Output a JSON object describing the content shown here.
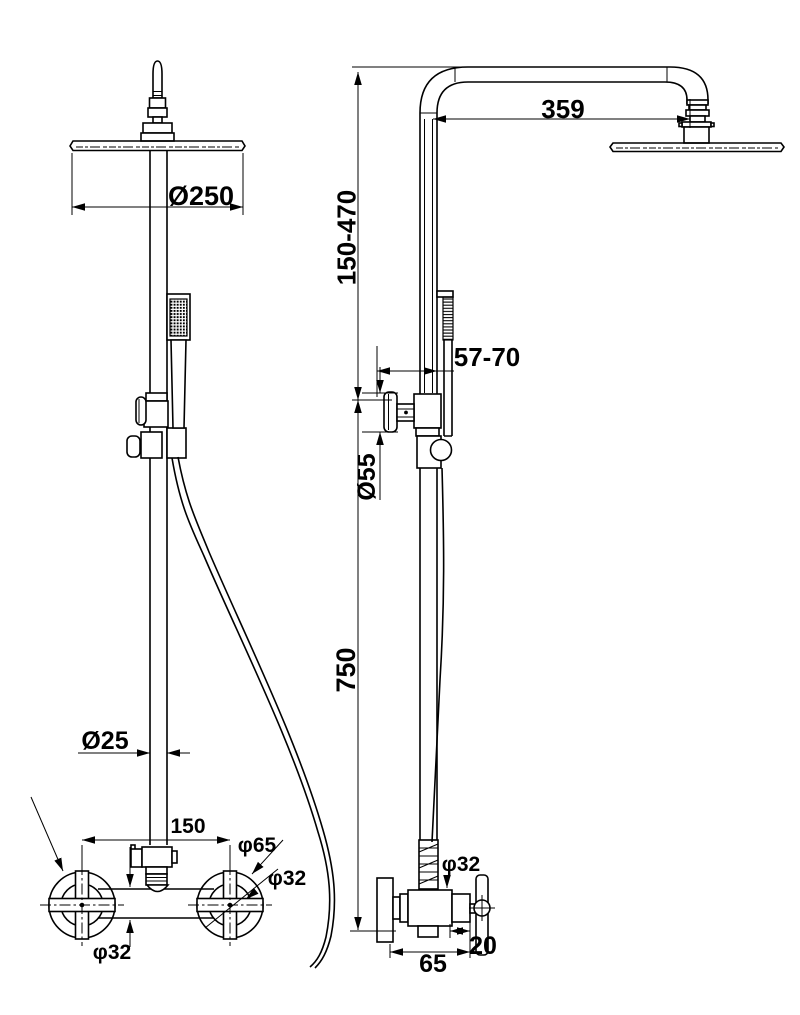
{
  "page": {
    "background": "#ffffff",
    "line_color": "#000000"
  },
  "labels": {
    "head_diameter": "Ø250",
    "arm_reach": "359",
    "riser_height_range": "150-470",
    "wall_offset_range": "57-70",
    "bracket_flange_diameter": "Ø55",
    "lower_riser_height": "750",
    "riser_pipe_diameter": "Ø25",
    "valve_inlet_spacing": "150",
    "handle_flange_diameter": "φ65",
    "handle_diameter": "φ32",
    "valve_body_diameter": "φ32",
    "riser_connector_diameter": "φ32",
    "outlet_offset": "20",
    "valve_body_width": "65"
  }
}
